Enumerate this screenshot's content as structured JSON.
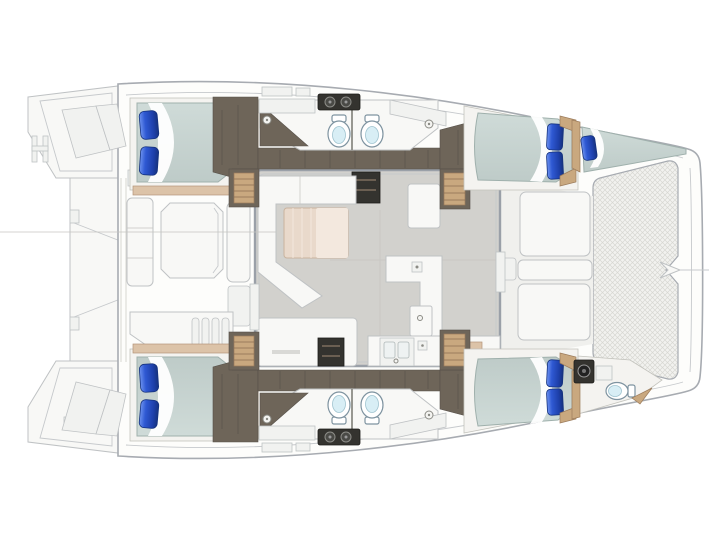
{
  "scene": {
    "type": "boat-deck-plan",
    "vessel": "catamaran",
    "view": "overhead-floor-plan",
    "bow_direction": "right"
  },
  "features": {
    "double_berths": 4,
    "bow_forepeak_berth": 1,
    "blue_pillows": 9,
    "toilets": 5,
    "head_compartments": 5,
    "companionway_stairs": 4,
    "salon_sofa": 1,
    "salon_table": 1,
    "galley_island": 1,
    "galley_sink": 1,
    "cooktop_units": 2,
    "aft_cockpit_table": 1,
    "forward_cockpit_cushions": 3,
    "bow_trampoline": 1,
    "stern_swim_platforms": 2,
    "boarding_ladder": 1
  },
  "colors": {
    "paper": "#ffffff",
    "line": "#a7abb1",
    "line-soft": "#c6c9cc",
    "deck-fill": "#fdfdfb",
    "furn": "#f8f8f6",
    "furn-stroke": "#bfc2c4",
    "salon-floor": "#d2d1cd",
    "wall": "#9aa0a8",
    "wood-dark": "#6e6559",
    "wood-dark-line": "#57514a",
    "wood-tan": "#c9a87f",
    "wood-tan-light": "#dcc3a8",
    "mattress-a": "#cfdbd8",
    "mattress-b": "#becbc8",
    "pillow-hi": "#6d92ef",
    "pillow-mid": "#2f59d3",
    "pillow-dark": "#16337f",
    "porcelain": "#d8eef5",
    "appliance": "#34332f",
    "mesh": "#f2f2ef",
    "mesh-line": "#d7d7d2",
    "table-wood": "#e9d9cb"
  }
}
